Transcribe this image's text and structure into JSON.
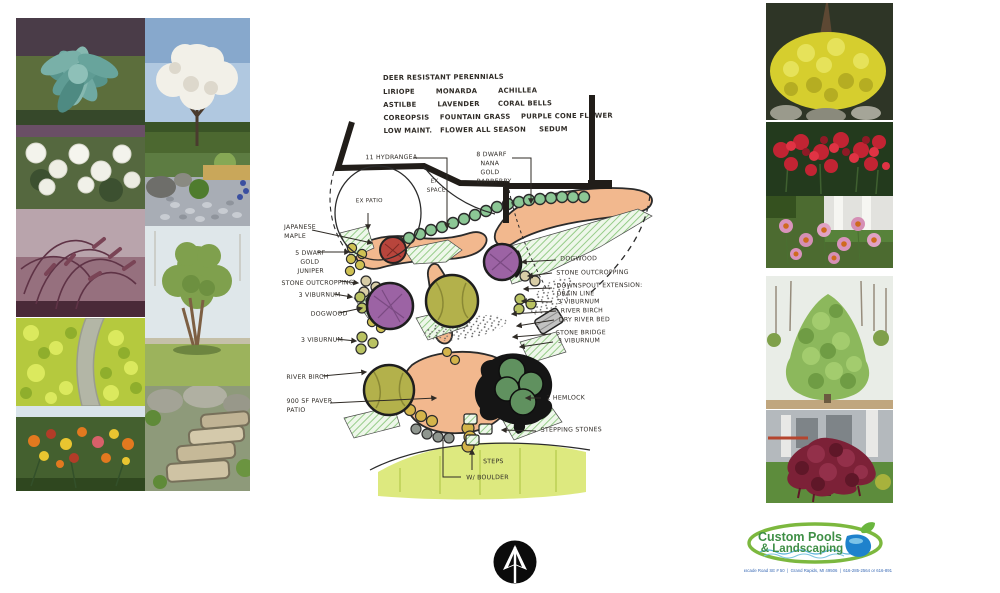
{
  "plant_list": {
    "lines": [
      "DEER RESISTANT PERENNIALS",
      "LIRIOPE        MONARDA        ACHILLEA",
      "ASTILBE        LAVENDER       CORAL BELLS",
      "COREOPSIS    FOUNTAIN GRASS    PURPLE CONE FLOWER",
      "LOW MAINT.   FLOWER ALL SEASON     SEDUM"
    ]
  },
  "sketch": {
    "labels": {
      "hydrangea": "11 HYDRANGEA",
      "dwarf_barberry": [
        "8 DWARF",
        "NANA",
        "GOLD",
        "BARBERRY"
      ],
      "ex_patio": "EX PATIO",
      "ex_space": [
        "EX",
        "SPACE"
      ],
      "japanese_maple": [
        "JAPANESE",
        "MAPLE"
      ],
      "dwarf_gold_juniper": [
        "5 DWARF",
        "GOLD",
        "JUNIPER"
      ],
      "stone_outcropping_l": "STONE OUTCROPPING",
      "viburnum_l1": "3 VIBURNUM",
      "dogwood_l": "DOGWOOD",
      "viburnum_l2": "3 VIBURNUM",
      "river_birch_l": "RIVER BIRCH",
      "paver_patio": [
        "900 SF PAVER",
        "PATIO"
      ],
      "dogwood_r": "DOGWOOD",
      "stone_outcropping_r": "STONE OUTCROPPING",
      "downspout": [
        "DOWNSPOUT EXTENSION:",
        "DRAIN LINE"
      ],
      "viburnum_r1": "3 VIBURNUM",
      "river_birch_r": "RIVER BIRCH",
      "dry_river_bed": "DRY RIVER BED",
      "stone_bridge": "STONE BRIDGE",
      "viburnum_r2": "3 VIBURNUM",
      "hemlock": "2 HEMLOCK",
      "stepping_stones": "STEPPING STONES",
      "steps": "STEPS",
      "w_boulder": "W/ BOULDER"
    },
    "palette": {
      "mulch_peach": "#f2b88e",
      "bed_hatch_green": "#8cc87e",
      "shrub_green": "#8cc795",
      "tree_olive": "#b3b14b",
      "tree_purple": "#9c63a4",
      "tree_red": "#b8453c",
      "hemlock_green": "#60915f",
      "lawn_green": "#dde97f",
      "ink": "#211d19"
    }
  },
  "gallery": {
    "left_outer": [
      "blue-hosta",
      "annabelle-hydrangea",
      "purple-fountain-grass",
      "gold-sedum-path",
      "daylilies"
    ],
    "left_inner": [
      "white-flowering-tree",
      "rock-garden",
      "river-birch-tree",
      "stone-slab-steps"
    ],
    "right": [
      "gold-barberry-shrub",
      "red-monarda",
      "purple-coneflower",
      "hemlock-tree",
      "weeping-japanese-maple"
    ]
  },
  "compass": {
    "symbol": "north-arrow"
  },
  "logo": {
    "name_line1": "Custom Pools",
    "name_line2": "& Landscaping",
    "address": "8787 Cascade Road SE # 50  |  Grand Rapids, MI 49506  |  616-285-2564 or 616-891-2735",
    "ring_color": "#7cb83e",
    "text_color": "#3f8f46",
    "pool_color": "#1e82cc"
  }
}
